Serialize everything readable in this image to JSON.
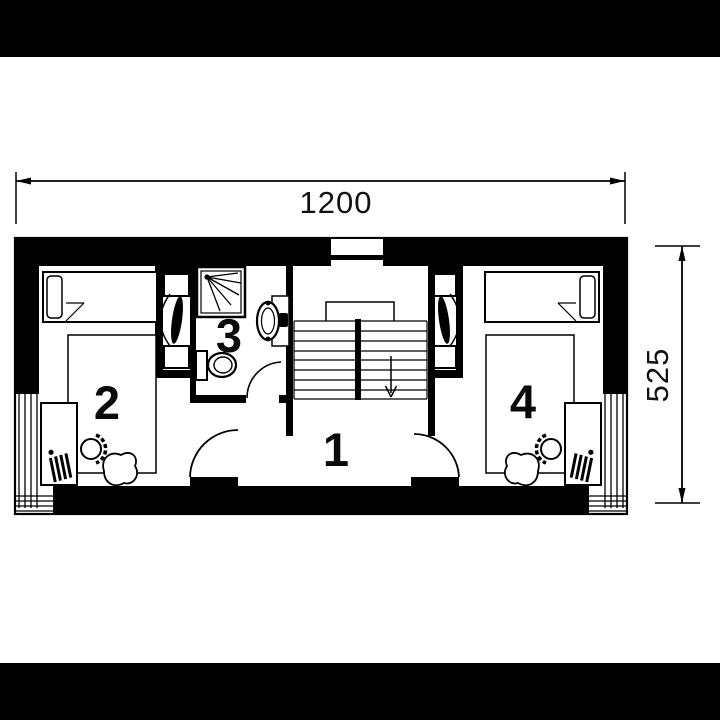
{
  "page": {
    "letterbox_color": "#000000",
    "paper_color": "#ffffff",
    "ink_color": "#000000",
    "drawing_type": "architectural-floor-plan"
  },
  "dimensions": {
    "width": "1200",
    "height": "525"
  },
  "rooms": [
    {
      "label": "1",
      "name": "hall-with-staircase"
    },
    {
      "label": "2",
      "name": "left-bedroom"
    },
    {
      "label": "3",
      "name": "bathroom"
    },
    {
      "label": "4",
      "name": "right-bedroom"
    }
  ],
  "fixtures": [
    "bed",
    "pillow",
    "rug",
    "desk",
    "office-chair",
    "plant",
    "shower",
    "toilet",
    "washbasin",
    "staircase",
    "door-swing",
    "window"
  ]
}
